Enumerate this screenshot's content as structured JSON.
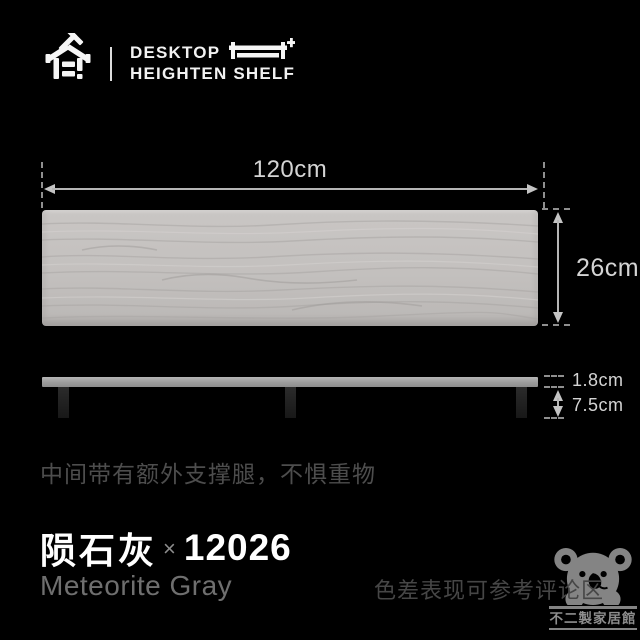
{
  "header": {
    "brand_line1": "DESKTOP",
    "brand_line2": "HEIGHTEN SHELF"
  },
  "diagram": {
    "width_label": "120cm",
    "height_label": "26cm",
    "thickness_label": "1.8cm",
    "leg_height_label": "7.5cm"
  },
  "caption": "中间带有额外支撑腿，不惧重物",
  "product": {
    "color_name_cn": "陨石灰",
    "separator": "×",
    "model_number": "12026",
    "color_name_en": "Meteorite Gray"
  },
  "note": "色差表现可参考评论区",
  "watermark": {
    "shop_name": "不二製家居館"
  },
  "icons": {
    "logo": "house-logo-icon",
    "shelf": "shelf-riser-icon",
    "bear": "koala-watermark-icon"
  },
  "colors": {
    "background": "#000000",
    "board_wood": "#c3c0be",
    "wood_grain_dark": "#a9a6a4",
    "side_bar": "#9c9c9c",
    "leg": "#1f1f1f",
    "dimension_line": "#b5b5b5",
    "dimension_text": "#d4d4d4",
    "caption_text": "#4d4d4d",
    "title_text": "#ffffff",
    "subtitle_text": "#6f6f6f",
    "note_text": "#464646",
    "watermark_gray": "#8c8c8c"
  }
}
